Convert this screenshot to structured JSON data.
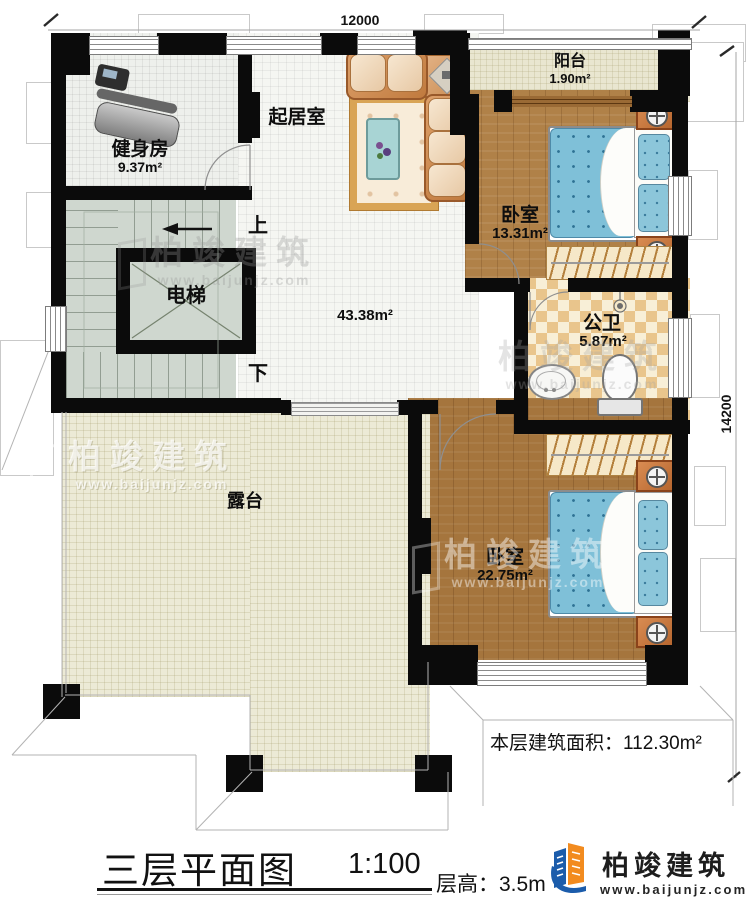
{
  "dimensions": {
    "width": "12000",
    "height": "14200"
  },
  "rooms": {
    "gym": {
      "name": "健身房",
      "area": "9.37m²"
    },
    "living": {
      "name": "起居室",
      "area": "43.38m²"
    },
    "balcony": {
      "name": "阳台",
      "area": "1.90m²"
    },
    "bedroom1": {
      "name": "卧室",
      "area": "13.31m²"
    },
    "bathroom": {
      "name": "公卫",
      "area": "5.87m²"
    },
    "bedroom2": {
      "name": "卧室",
      "area": "22.75m²"
    },
    "elevator": {
      "name": "电梯"
    },
    "terrace": {
      "name": "露台"
    }
  },
  "stairs": {
    "up_label": "上",
    "down_label": "下"
  },
  "footer": {
    "floor_area": "本层建筑面积：112.30m²",
    "title": "三层平面图",
    "scale": "1:100",
    "floor_height": "层高：3.5m"
  },
  "brand": {
    "name": "柏竣建筑",
    "url": "www.baijunjz.com"
  },
  "watermark": {
    "name": "柏竣建筑",
    "url": "www.baijunjz.com"
  },
  "colors": {
    "wall": "#0b0b0b",
    "wood": "#aa7a42",
    "mattress": "#7fc0d8",
    "bath_tile": "#e9c58c",
    "stairs": "#cfd7cf",
    "terrace": "#ecead6",
    "logo_blue": "#1b5cab",
    "logo_orange": "#f28b1f"
  }
}
